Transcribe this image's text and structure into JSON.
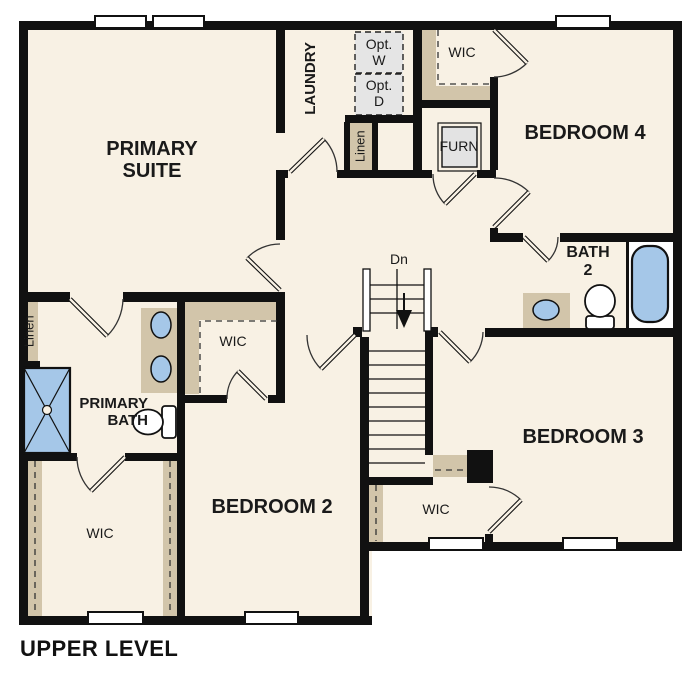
{
  "title": "UPPER LEVEL",
  "labels": {
    "primary_suite": "PRIMARY\nSUITE",
    "laundry": "LAUNDRY",
    "opt_w": "Opt.\nW",
    "opt_d": "Opt.\nD",
    "wic_bedroom4": "WIC",
    "bedroom4": "BEDROOM 4",
    "furn": "FURN",
    "linen_hall": "Linen",
    "linen_bath": "Linen",
    "bath2": "BATH\n2",
    "stairs_down": "Dn",
    "primary_bath": "PRIMARY\nBATH",
    "wic_bedroom2": "WIC",
    "bedroom2": "BEDROOM 2",
    "wic_primary": "WIC",
    "bedroom3": "BEDROOM 3",
    "wic_bedroom3": "WIC"
  },
  "colors": {
    "floor": "#F8F1E4",
    "casework_tan": "#D2C5AA",
    "fixture_blue": "#A5C7E8",
    "optional_gray": "#E5E5E5",
    "wall_black": "#111111",
    "outside_white": "#FFFFFF"
  }
}
